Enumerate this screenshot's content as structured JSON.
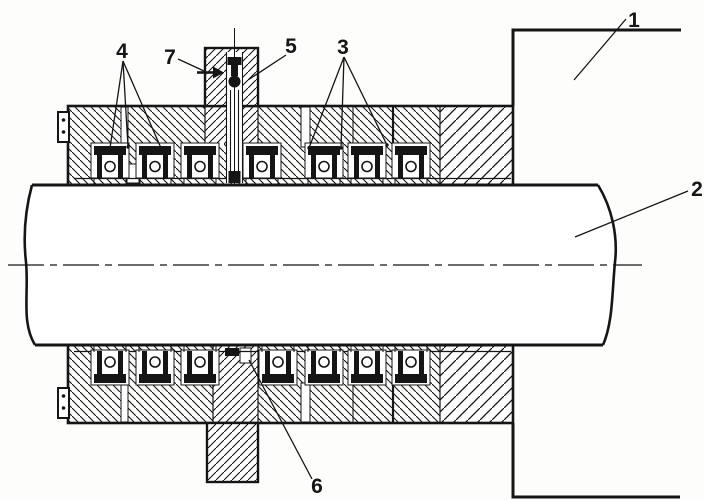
{
  "colors": {
    "ink": "#151515",
    "background": "#fdfdfc"
  },
  "callouts": {
    "housing": {
      "label": "1"
    },
    "shaft": {
      "label": "2"
    },
    "seals_right": {
      "label": "3"
    },
    "seals_left": {
      "label": "4"
    },
    "upper_gland": {
      "label": "5"
    },
    "lower_gland": {
      "label": "6"
    },
    "feed_pin": {
      "label": "7"
    }
  }
}
